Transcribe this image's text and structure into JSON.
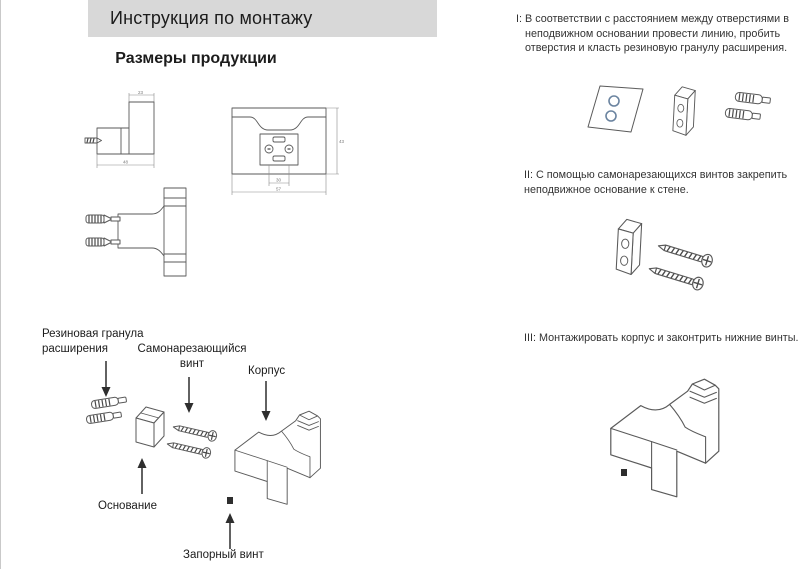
{
  "header": {
    "title": "Инструкция по монтажу"
  },
  "left": {
    "section_title": "Размеры продукции",
    "dimensions": {
      "side_top": "23",
      "side_width": "48",
      "front_holes": "30",
      "front_width": "57",
      "front_height": "43"
    }
  },
  "parts": {
    "rubber_plug": "Резиновая гранула расширения",
    "tapping_screw": "Самонарезающийся винт",
    "body": "Корпус",
    "base": "Основание",
    "lock_screw": "Запорный винт"
  },
  "steps": [
    {
      "text": "I: В соответствии с расстоянием между отверстиями в неподвижном основании провести линию, пробить отверстия и класть резиновую гранулу расширения."
    },
    {
      "text": "II: С помощью самонарезающихся винтов закрепить неподвижное основание к стене."
    },
    {
      "text": "III: Монтажировать корпус и законтрить нижние винты."
    }
  ],
  "colors": {
    "header_bg": "#d8d8d8",
    "line": "#555555",
    "hole_blue": "#6b84a0"
  }
}
